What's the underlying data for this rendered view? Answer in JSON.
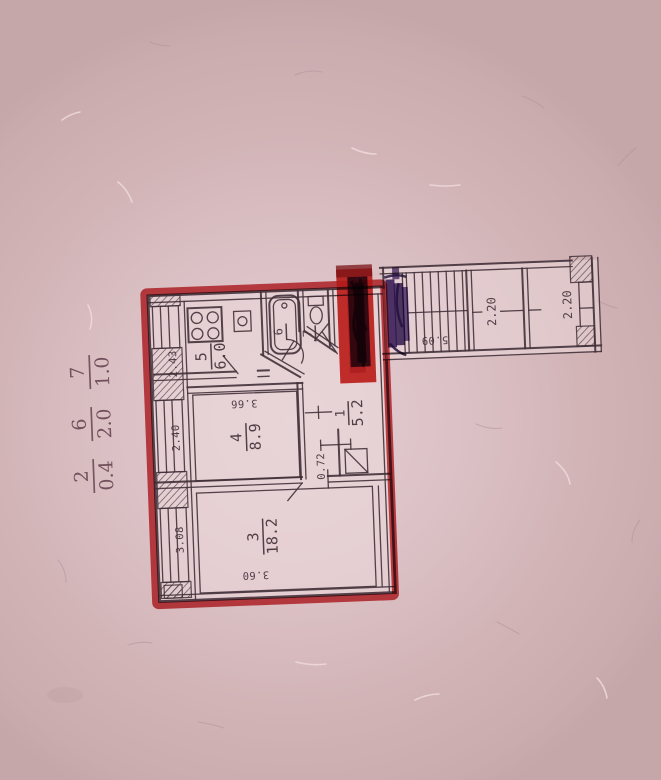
{
  "paper": {
    "base": "#d2b4b7",
    "light": "#e3ced2"
  },
  "ink_color": "#42313a",
  "marker_colors": {
    "red": "#c82a30",
    "purple": "#2a1150"
  },
  "apartment": {
    "rooms": {
      "hall": {
        "num": "1",
        "area": "5.2"
      },
      "room3": {
        "num": "3",
        "area": "18.2"
      },
      "room4": {
        "num": "4",
        "area": "8.9"
      },
      "kitchen": {
        "num": "5",
        "area": "6.0"
      },
      "bath": {
        "num": "6"
      },
      "wc": {
        "num": "7"
      }
    },
    "dims": {
      "kitchen_w": "2.43",
      "room4_w": "3.66",
      "room4_d": "2.40",
      "hall_pass": "0.72",
      "room3_d": "3.08",
      "room3_w": "3.60"
    }
  },
  "stairwell": {
    "corridor_len": "5.09",
    "bay1": "2.20",
    "bay2": "2.20"
  },
  "margin_notes": {
    "n1": {
      "num": "2",
      "den": "0.4"
    },
    "n2": {
      "num": "6",
      "den": "2.0"
    },
    "n3": {
      "num": "7",
      "den": "1.0"
    }
  }
}
